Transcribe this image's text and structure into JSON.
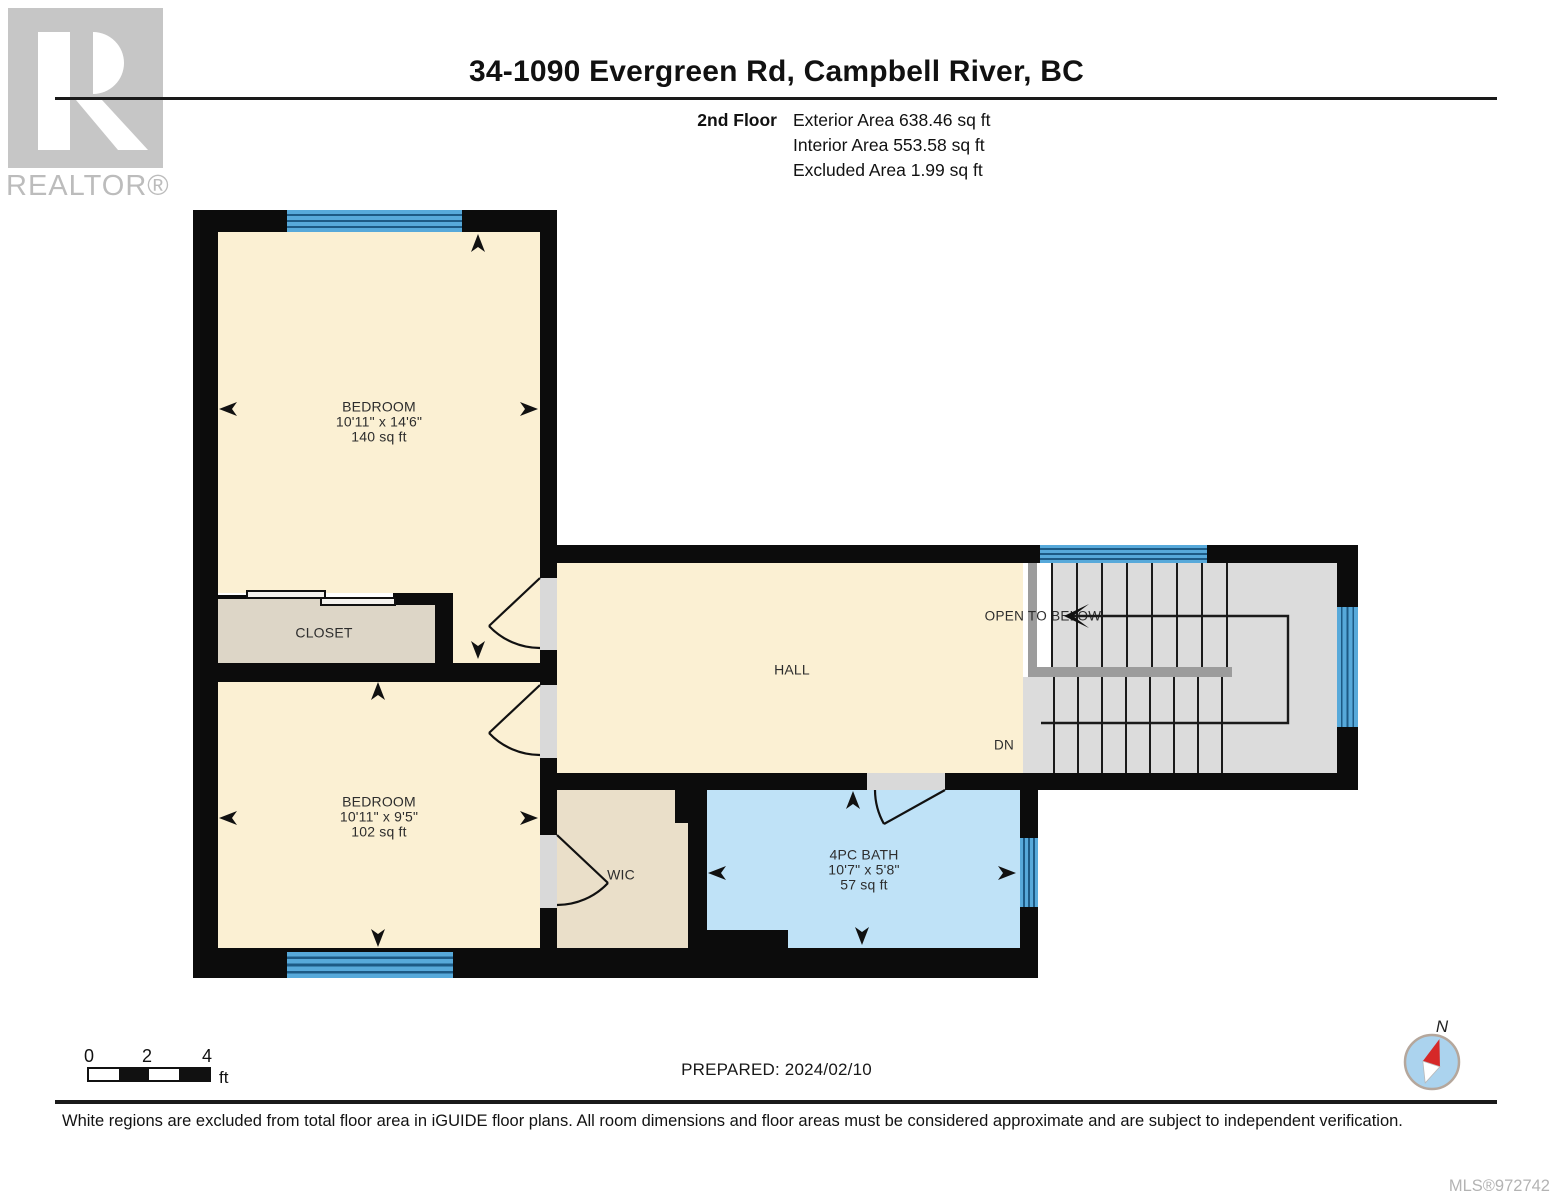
{
  "header": {
    "logo_text": "REALTOR®",
    "title": "34-1090 Evergreen Rd, Campbell River, BC",
    "floor_label": "2nd Floor",
    "areas": [
      "Exterior Area 638.46 sq ft",
      "Interior Area 553.58 sq ft",
      "Excluded Area 1.99 sq ft"
    ]
  },
  "floorplan": {
    "rooms": {
      "bedroom1": {
        "name": "BEDROOM",
        "dims": "10'11\" x 14'6\"",
        "area": "140 sq ft"
      },
      "closet": {
        "name": "CLOSET"
      },
      "bedroom2": {
        "name": "BEDROOM",
        "dims": "10'11\" x 9'5\"",
        "area": "102 sq ft"
      },
      "hall": {
        "name": "HALL"
      },
      "wic": {
        "name": "WIC"
      },
      "bath": {
        "name": "4PC BATH",
        "dims": "10'7\" x 5'8\"",
        "area": "57 sq ft"
      }
    },
    "annotations": {
      "open_to_below": "OPEN TO BELOW",
      "down": "DN"
    },
    "colors": {
      "wall": "#0c0c0c",
      "floor_cream": "#fbf0d3",
      "closet_tan": "#ddd6c7",
      "wic_tan": "#eadfc9",
      "bath_blue": "#bfe2f7",
      "window_blue": "#57a9da",
      "stair_gray": "#dcdcdc",
      "compass_red": "#d62828"
    }
  },
  "footer": {
    "scale": {
      "ticks": [
        "0",
        "2",
        "4"
      ],
      "unit": "ft"
    },
    "prepared": "PREPARED: 2024/02/10",
    "compass_label": "N",
    "disclaimer": "White regions are excluded from total floor area in iGUIDE floor plans. All room dimensions and floor areas must be considered approximate and are subject to independent verification.",
    "mls": "MLS®972742"
  }
}
